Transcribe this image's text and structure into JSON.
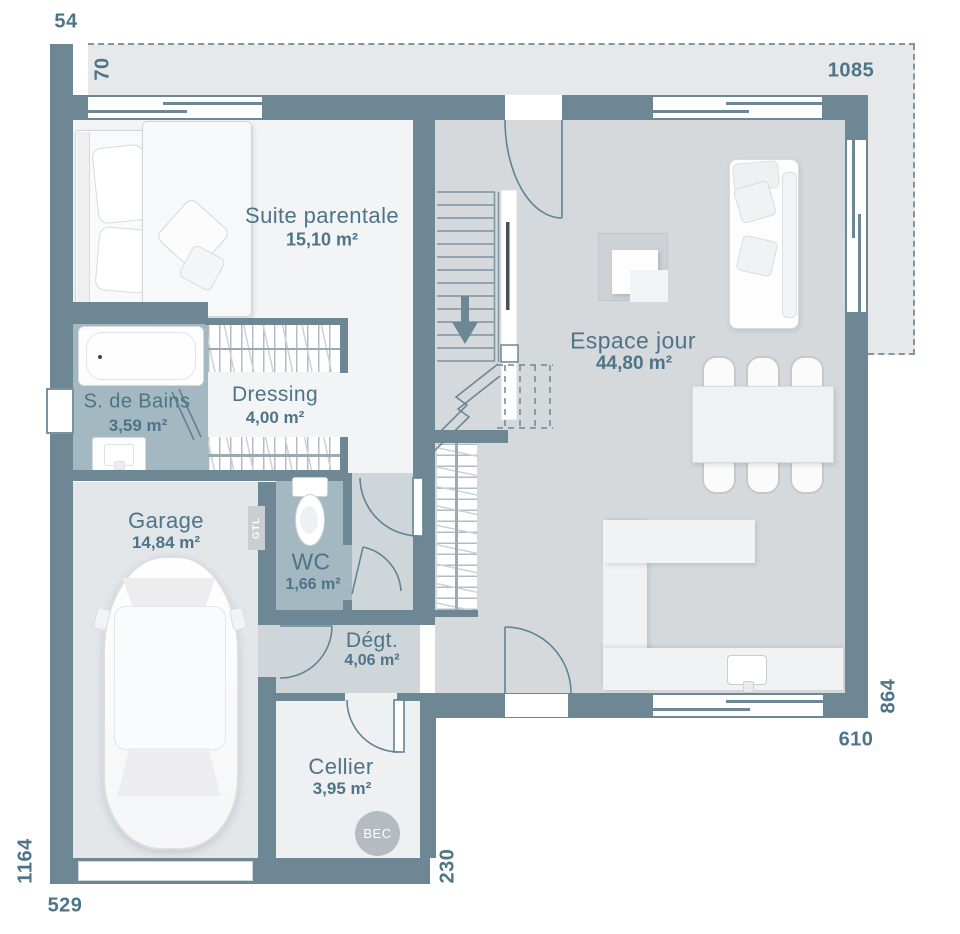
{
  "plan": {
    "dimensions": {
      "top_left": "54",
      "top_band": "70",
      "top_right": "1085",
      "left_side": "1164",
      "bottom_left": "529",
      "cellier_right": "230",
      "bottom_right": "610",
      "right_side": "864"
    },
    "rooms": {
      "suite": {
        "name": "Suite parentale",
        "area": "15,10 m²"
      },
      "sdb": {
        "name": "S. de Bains",
        "area": "3,59 m²"
      },
      "dressing": {
        "name": "Dressing",
        "area": "4,00 m²"
      },
      "garage": {
        "name": "Garage",
        "area": "14,84 m²"
      },
      "wc": {
        "name": "WC",
        "area": "1,66 m²"
      },
      "degt": {
        "name": "Dégt.",
        "area": "4,06 m²"
      },
      "cellier": {
        "name": "Cellier",
        "area": "3,95 m²"
      },
      "espace": {
        "name": "Espace jour",
        "area": "44,80 m²"
      }
    },
    "annotations": {
      "bec": "BEC",
      "gtl": "GTL"
    },
    "colors": {
      "wall": "#6d8794",
      "wet_room_floor": "#a3b8c1",
      "living_floor": "#d5d9dc",
      "hall_floor": "#cfd6da",
      "terrace": "#e6e8ea",
      "text": "#4d7488"
    }
  }
}
